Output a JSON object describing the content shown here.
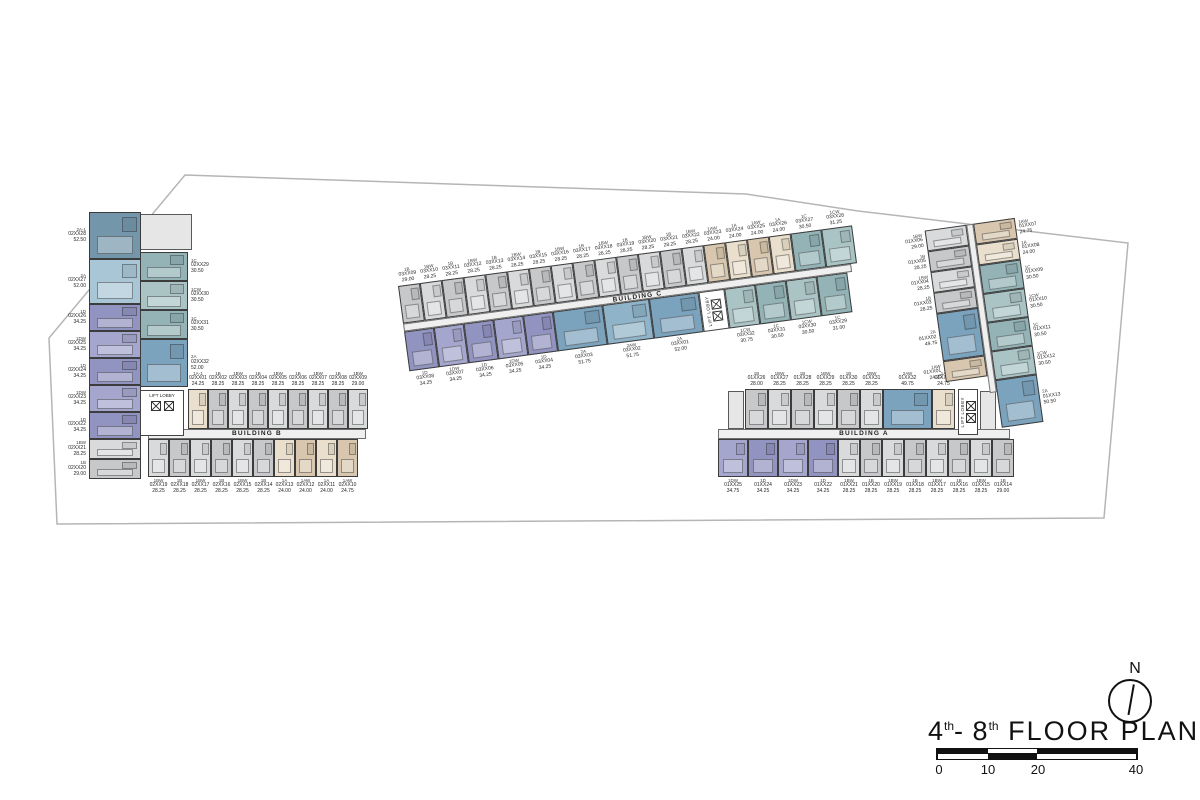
{
  "title_block": {
    "title_p1": "4",
    "title_sup1": "th",
    "title_p2": "- 8",
    "title_sup2": "th",
    "title_p3": " FLOOR PLAN",
    "north_label": "N",
    "scale_ticks": [
      "0",
      "10",
      "20",
      "40"
    ]
  },
  "palette": {
    "blue_dark": "#7496ab",
    "blue_light": "#a9c6d6",
    "blue_med": "#7ba3bd",
    "blue_med2": "#8fb3c8",
    "purple": "#9193c0",
    "purple_light": "#a4a6cd",
    "teal": "#93b3b6",
    "teal_light": "#aac4c6",
    "gray": "#c6c8ca",
    "gray_light": "#d8dadb",
    "beige": "#e9dfcc",
    "beige_dark": "#d8c7ae",
    "boundary": "#b5b5b5",
    "wall": "#3c3c3c"
  },
  "buildings": {
    "b": {
      "label": "BUILDING B",
      "lift_label": "LIFT LOBBY",
      "left_col": [
        {
          "id": "02XX28",
          "type": "2A-1",
          "area": "52.50",
          "color": "blue_dark"
        },
        {
          "id": "02XX27",
          "type": "2A",
          "area": "52.00",
          "color": "blue_light"
        },
        {
          "id": "02XX26",
          "type": "1D",
          "area": "34.25",
          "color": "purple"
        },
        {
          "id": "02XX25",
          "type": "1DW",
          "area": "34.25",
          "color": "purple_light"
        },
        {
          "id": "02XX24",
          "type": "1D",
          "area": "34.25",
          "color": "purple"
        },
        {
          "id": "02XX23",
          "type": "1DW",
          "area": "34.25",
          "color": "purple_light"
        },
        {
          "id": "02XX22",
          "type": "1D",
          "area": "34.25",
          "color": "purple"
        },
        {
          "id": "02XX21",
          "type": "1BW",
          "area": "28.25",
          "color": "gray_light"
        },
        {
          "id": "02XX20",
          "type": "1B",
          "area": "29.00",
          "color": "gray"
        }
      ],
      "mid_col": [
        {
          "id": "02XX29",
          "type": "1C",
          "area": "30.50",
          "color": "teal"
        },
        {
          "id": "02XX30",
          "type": "1CW",
          "area": "30.50",
          "color": "teal_light"
        },
        {
          "id": "02XX31",
          "type": "1C",
          "area": "30.50",
          "color": "teal"
        },
        {
          "id": "02XX32",
          "type": "2A",
          "area": "52.00",
          "color": "blue_med"
        }
      ],
      "top_row": [
        {
          "id": "02XX01",
          "type": "1A-1",
          "area": "24.25",
          "color": "beige"
        },
        {
          "id": "02XX02",
          "type": "1B",
          "area": "28.25",
          "color": "gray"
        },
        {
          "id": "02XX03",
          "type": "1BW",
          "area": "28.25",
          "color": "gray_light"
        },
        {
          "id": "02XX04",
          "type": "1B",
          "area": "28.25",
          "color": "gray"
        },
        {
          "id": "02XX05",
          "type": "1BW",
          "area": "28.25",
          "color": "gray_light"
        },
        {
          "id": "02XX06",
          "type": "1B",
          "area": "28.25",
          "color": "gray"
        },
        {
          "id": "02XX07",
          "type": "1BW",
          "area": "28.25",
          "color": "gray_light"
        },
        {
          "id": "02XX08",
          "type": "1B",
          "area": "28.25",
          "color": "gray"
        },
        {
          "id": "02XX09",
          "type": "1BW",
          "area": "29.00",
          "color": "gray_light"
        }
      ],
      "bottom_row": [
        {
          "id": "02XX19",
          "type": "1BW",
          "area": "28.25",
          "color": "gray_light"
        },
        {
          "id": "02XX18",
          "type": "1B",
          "area": "28.25",
          "color": "gray"
        },
        {
          "id": "02XX17",
          "type": "1BW",
          "area": "28.25",
          "color": "gray_light"
        },
        {
          "id": "02XX16",
          "type": "1B",
          "area": "28.25",
          "color": "gray"
        },
        {
          "id": "02XX15",
          "type": "1BW",
          "area": "28.25",
          "color": "gray_light"
        },
        {
          "id": "02XX14",
          "type": "1B",
          "area": "28.25",
          "color": "gray"
        },
        {
          "id": "02XX13",
          "type": "1A",
          "area": "24.00",
          "color": "beige"
        },
        {
          "id": "02XX12",
          "type": "1AW",
          "area": "24.00",
          "color": "beige_dark"
        },
        {
          "id": "02XX11",
          "type": "1A",
          "area": "24.00",
          "color": "beige"
        },
        {
          "id": "02XX10",
          "type": "1AW",
          "area": "24.75",
          "color": "beige_dark"
        }
      ]
    },
    "c": {
      "label": "BUILDING C",
      "lift_label": "LIFT LOBBY",
      "top_row": [
        {
          "id": "03XX09",
          "type": "1B",
          "area": "29.00",
          "color": "gray"
        },
        {
          "id": "03XX10",
          "type": "1BW",
          "area": "28.25",
          "color": "gray_light"
        },
        {
          "id": "03XX11",
          "type": "1B",
          "area": "28.25",
          "color": "gray"
        },
        {
          "id": "03XX12",
          "type": "1BW",
          "area": "28.25",
          "color": "gray_light"
        },
        {
          "id": "03XX13",
          "type": "1B",
          "area": "28.25",
          "color": "gray"
        },
        {
          "id": "03XX14",
          "type": "1BW",
          "area": "28.25",
          "color": "gray_light"
        },
        {
          "id": "03XX15",
          "type": "1B",
          "area": "28.25",
          "color": "gray"
        },
        {
          "id": "03XX16",
          "type": "1BW",
          "area": "28.25",
          "color": "gray_light"
        },
        {
          "id": "03XX17",
          "type": "1B",
          "area": "28.25",
          "color": "gray"
        },
        {
          "id": "03XX18",
          "type": "1BW",
          "area": "28.25",
          "color": "gray_light"
        },
        {
          "id": "03XX19",
          "type": "1B",
          "area": "28.25",
          "color": "gray"
        },
        {
          "id": "03XX20",
          "type": "1BW",
          "area": "28.25",
          "color": "gray_light"
        },
        {
          "id": "03XX21",
          "type": "1B",
          "area": "28.25",
          "color": "gray"
        },
        {
          "id": "03XX22",
          "type": "1BW",
          "area": "28.25",
          "color": "gray_light"
        },
        {
          "id": "03XX23",
          "type": "1AW",
          "area": "24.00",
          "color": "beige_dark"
        },
        {
          "id": "03XX24",
          "type": "1A",
          "area": "24.00",
          "color": "beige"
        },
        {
          "id": "03XX25",
          "type": "1AW",
          "area": "24.00",
          "color": "beige_dark"
        },
        {
          "id": "03XX26",
          "type": "1A",
          "area": "24.00",
          "color": "beige"
        },
        {
          "id": "03XX27",
          "type": "1C",
          "area": "30.50",
          "color": "teal"
        },
        {
          "id": "03XX28",
          "type": "1CW",
          "area": "31.25",
          "color": "teal_light"
        }
      ],
      "bottom_row": [
        {
          "id": "03XX08",
          "type": "1D",
          "area": "34.25",
          "color": "purple"
        },
        {
          "id": "03XX07",
          "type": "1DW",
          "area": "34.25",
          "color": "purple_light"
        },
        {
          "id": "03XX06",
          "type": "1D",
          "area": "34.25",
          "color": "purple"
        },
        {
          "id": "03XX05",
          "type": "1DW",
          "area": "34.25",
          "color": "purple_light"
        },
        {
          "id": "03XX04",
          "type": "1D",
          "area": "34.25",
          "color": "purple"
        },
        {
          "id": "03XX03",
          "type": "2A",
          "area": "51.75",
          "color": "blue_med"
        },
        {
          "id": "03XX02",
          "type": "2AW",
          "area": "51.75",
          "color": "blue_med2"
        },
        {
          "id": "03XX01",
          "type": "2A",
          "area": "52.00",
          "color": "blue_med"
        }
      ],
      "annex_row": [
        {
          "id": "03XX32",
          "type": "1CW",
          "area": "30.75",
          "color": "teal_light"
        },
        {
          "id": "03XX31",
          "type": "1C",
          "area": "30.50",
          "color": "teal"
        },
        {
          "id": "03XX30",
          "type": "1CW",
          "area": "30.50",
          "color": "teal_light"
        },
        {
          "id": "03XX29",
          "type": "1C",
          "area": "31.00",
          "color": "teal"
        }
      ]
    },
    "a": {
      "label": "BUILDING A",
      "lift_label": "LIFT LOBBY",
      "top_row": [
        {
          "id": "01XX26",
          "type": "1B",
          "area": "28.00",
          "color": "gray"
        },
        {
          "id": "01XX27",
          "type": "1BW",
          "area": "28.25",
          "color": "gray_light"
        },
        {
          "id": "01XX28",
          "type": "1B",
          "area": "28.25",
          "color": "gray"
        },
        {
          "id": "01XX29",
          "type": "1BW",
          "area": "28.25",
          "color": "gray_light"
        },
        {
          "id": "01XX30",
          "type": "1B",
          "area": "28.25",
          "color": "gray"
        },
        {
          "id": "01XX31",
          "type": "1BW",
          "area": "28.25",
          "color": "gray_light"
        },
        {
          "id": "01XX32",
          "type": "2AW",
          "area": "49.75",
          "color": "blue_med"
        },
        {
          "id": "01XX33",
          "type": "1A",
          "area": "24.75",
          "color": "beige"
        }
      ],
      "bottom_row": [
        {
          "id": "01XX25",
          "type": "1DW",
          "area": "34.75",
          "color": "purple_light"
        },
        {
          "id": "01XX24",
          "type": "1D",
          "area": "34.25",
          "color": "purple"
        },
        {
          "id": "01XX23",
          "type": "1DW",
          "area": "34.25",
          "color": "purple_light"
        },
        {
          "id": "01XX22",
          "type": "1D",
          "area": "34.25",
          "color": "purple"
        },
        {
          "id": "01XX21",
          "type": "1BW",
          "area": "28.25",
          "color": "gray_light"
        },
        {
          "id": "01XX20",
          "type": "1B",
          "area": "28.25",
          "color": "gray"
        },
        {
          "id": "01XX19",
          "type": "1BW",
          "area": "28.25",
          "color": "gray_light"
        },
        {
          "id": "01XX18",
          "type": "1B",
          "area": "28.25",
          "color": "gray"
        },
        {
          "id": "01XX17",
          "type": "1BW",
          "area": "28.25",
          "color": "gray_light"
        },
        {
          "id": "01XX16",
          "type": "1B",
          "area": "28.25",
          "color": "gray"
        },
        {
          "id": "01XX15",
          "type": "1BW",
          "area": "28.25",
          "color": "gray_light"
        },
        {
          "id": "01XX14",
          "type": "1B",
          "area": "29.00",
          "color": "gray"
        }
      ],
      "right_col_left": [
        {
          "id": "01XX06",
          "type": "1BW",
          "area": "29.00",
          "color": "gray_light"
        },
        {
          "id": "01XX05",
          "type": "1B",
          "area": "28.25",
          "color": "gray"
        },
        {
          "id": "01XX04",
          "type": "1BW",
          "area": "28.25",
          "color": "gray_light"
        },
        {
          "id": "01XX03",
          "type": "1B",
          "area": "28.25",
          "color": "gray"
        },
        {
          "id": "01XX02",
          "type": "2A",
          "area": "49.75",
          "color": "blue_med"
        },
        {
          "id": "01XX01",
          "type": "1AW",
          "area": "24.25",
          "color": "beige_dark"
        }
      ],
      "right_col_right": [
        {
          "id": "01XX07",
          "type": "1AW",
          "area": "24.75",
          "color": "beige_dark"
        },
        {
          "id": "01XX08",
          "type": "1A",
          "area": "24.00",
          "color": "beige"
        },
        {
          "id": "01XX09",
          "type": "1C",
          "area": "30.50",
          "color": "teal"
        },
        {
          "id": "01XX10",
          "type": "1CW",
          "area": "30.50",
          "color": "teal_light"
        },
        {
          "id": "01XX11",
          "type": "1C",
          "area": "30.50",
          "color": "teal"
        },
        {
          "id": "01XX12",
          "type": "1CW",
          "area": "30.50",
          "color": "teal_light"
        },
        {
          "id": "01XX13",
          "type": "2A",
          "area": "50.50",
          "color": "blue_med"
        }
      ]
    }
  }
}
